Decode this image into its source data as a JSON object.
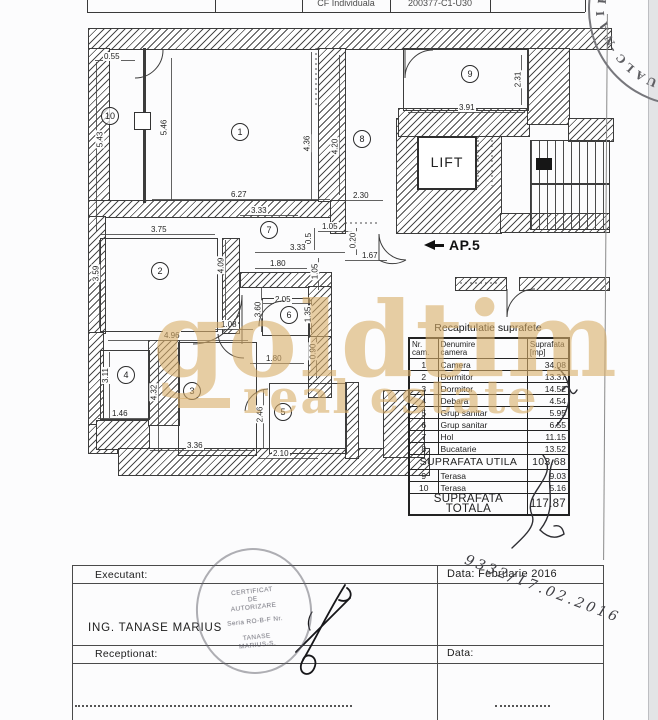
{
  "header": {
    "cell1": "CF Individuala",
    "cell2": "200377-C1-U30"
  },
  "corner_stamp": {
    "letters": [
      "R",
      "I",
      "A",
      "N",
      "-",
      "C",
      "L",
      "A",
      "U"
    ]
  },
  "plan": {
    "ap5_label": "AP.5",
    "lift_label": "LIFT",
    "rooms": [
      {
        "num": "1",
        "x": 240,
        "y": 132
      },
      {
        "num": "2",
        "x": 160,
        "y": 271
      },
      {
        "num": "3",
        "x": 192,
        "y": 391
      },
      {
        "num": "4",
        "x": 126,
        "y": 375
      },
      {
        "num": "5",
        "x": 283,
        "y": 412
      },
      {
        "num": "6",
        "x": 289,
        "y": 315
      },
      {
        "num": "7",
        "x": 269,
        "y": 230
      },
      {
        "num": "8",
        "x": 362,
        "y": 139
      },
      {
        "num": "9",
        "x": 470,
        "y": 74
      },
      {
        "num": "10",
        "x": 110,
        "y": 116
      }
    ],
    "dims": [
      {
        "t": "0.55",
        "x": 113,
        "y": 57
      },
      {
        "t": "5.43",
        "x": 101,
        "y": 140,
        "v": 1
      },
      {
        "t": "5.46",
        "x": 165,
        "y": 128,
        "v": 1
      },
      {
        "t": "6.27",
        "x": 240,
        "y": 195
      },
      {
        "t": "4.36",
        "x": 308,
        "y": 144,
        "v": 1
      },
      {
        "t": "4.20",
        "x": 336,
        "y": 147,
        "v": 1
      },
      {
        "t": "2.30",
        "x": 362,
        "y": 196
      },
      {
        "t": "2.31",
        "x": 519,
        "y": 80,
        "v": 1
      },
      {
        "t": "3.91",
        "x": 468,
        "y": 108
      },
      {
        "t": "3.33",
        "x": 260,
        "y": 211
      },
      {
        "t": "1.05",
        "x": 331,
        "y": 227
      },
      {
        "t": "0.5",
        "x": 312,
        "y": 239,
        "v": 1
      },
      {
        "t": "0.20",
        "x": 354,
        "y": 241,
        "v": 1
      },
      {
        "t": "1.67",
        "x": 371,
        "y": 256
      },
      {
        "t": "3.33",
        "x": 299,
        "y": 248
      },
      {
        "t": "1.05",
        "x": 316,
        "y": 272,
        "v": 1
      },
      {
        "t": "3.75",
        "x": 160,
        "y": 230
      },
      {
        "t": "3.59",
        "x": 97,
        "y": 274,
        "v": 1
      },
      {
        "t": "4.09",
        "x": 222,
        "y": 266,
        "v": 1
      },
      {
        "t": "1.80",
        "x": 279,
        "y": 264
      },
      {
        "t": "2.05",
        "x": 284,
        "y": 300
      },
      {
        "t": "1.35",
        "x": 309,
        "y": 315,
        "v": 1
      },
      {
        "t": "3.60",
        "x": 259,
        "y": 310,
        "v": 1
      },
      {
        "t": "1.08",
        "x": 230,
        "y": 325
      },
      {
        "t": "4.96",
        "x": 173,
        "y": 336
      },
      {
        "t": "1.80",
        "x": 275,
        "y": 359
      },
      {
        "t": "0.90",
        "x": 314,
        "y": 352,
        "v": 1
      },
      {
        "t": "3.11",
        "x": 107,
        "y": 376,
        "v": 1
      },
      {
        "t": "1.46",
        "x": 121,
        "y": 414
      },
      {
        "t": "4.32",
        "x": 155,
        "y": 393,
        "v": 1
      },
      {
        "t": "3.36",
        "x": 196,
        "y": 446
      },
      {
        "t": "2.46",
        "x": 261,
        "y": 415,
        "v": 1
      },
      {
        "t": "2.10",
        "x": 282,
        "y": 454
      }
    ]
  },
  "area_table": {
    "title": "Recapitulatie suprafete",
    "col1_h": [
      "Nr.",
      "cam."
    ],
    "col2_h": [
      "Denumire",
      "camera"
    ],
    "col3_h": [
      "Suprafata",
      "[mp]"
    ],
    "rows": [
      {
        "nr": "1",
        "name": "Camera",
        "mp": "34.08"
      },
      {
        "nr": "2",
        "name": "Dormitor",
        "mp": "13.37"
      },
      {
        "nr": "3",
        "name": "Dormitor",
        "mp": "14.52"
      },
      {
        "nr": "4",
        "name": "Debara",
        "mp": "4.54"
      },
      {
        "nr": "5",
        "name": "Grup sanitar",
        "mp": "5.95"
      },
      {
        "nr": "6",
        "name": "Grup sanitar",
        "mp": "6.55"
      },
      {
        "nr": "7",
        "name": "Hol",
        "mp": "11.15"
      },
      {
        "nr": "8",
        "name": "Bucatarie",
        "mp": "13.52"
      }
    ],
    "utila": {
      "label": "SUPRAFATA UTILA",
      "value": "103.68"
    },
    "rows2": [
      {
        "nr": "9",
        "name": "Terasa",
        "mp": "9.03"
      },
      {
        "nr": "10",
        "name": "Terasa",
        "mp": "5.16"
      }
    ],
    "totala": {
      "label": "SUPRAFATA TOTALA",
      "value": "117.87"
    }
  },
  "watermark": {
    "line1": "goldtim",
    "line2": "real estate",
    "color": "#d9ae69"
  },
  "footer": {
    "executant_label": "Executant:",
    "engineer": "ING. TANASE  MARIUS",
    "receptionat_label": "Receptionat:",
    "data1": "Data: Februarie 2016",
    "data2": "Data:",
    "handwritten": "9332/17.02.2016",
    "stamp_lines": [
      "CERTIFICAT",
      "DE",
      "AUTORIZARE",
      "",
      "Seria RO-B-F Nr.",
      "",
      "TANASE",
      "MARIUS-S."
    ]
  }
}
